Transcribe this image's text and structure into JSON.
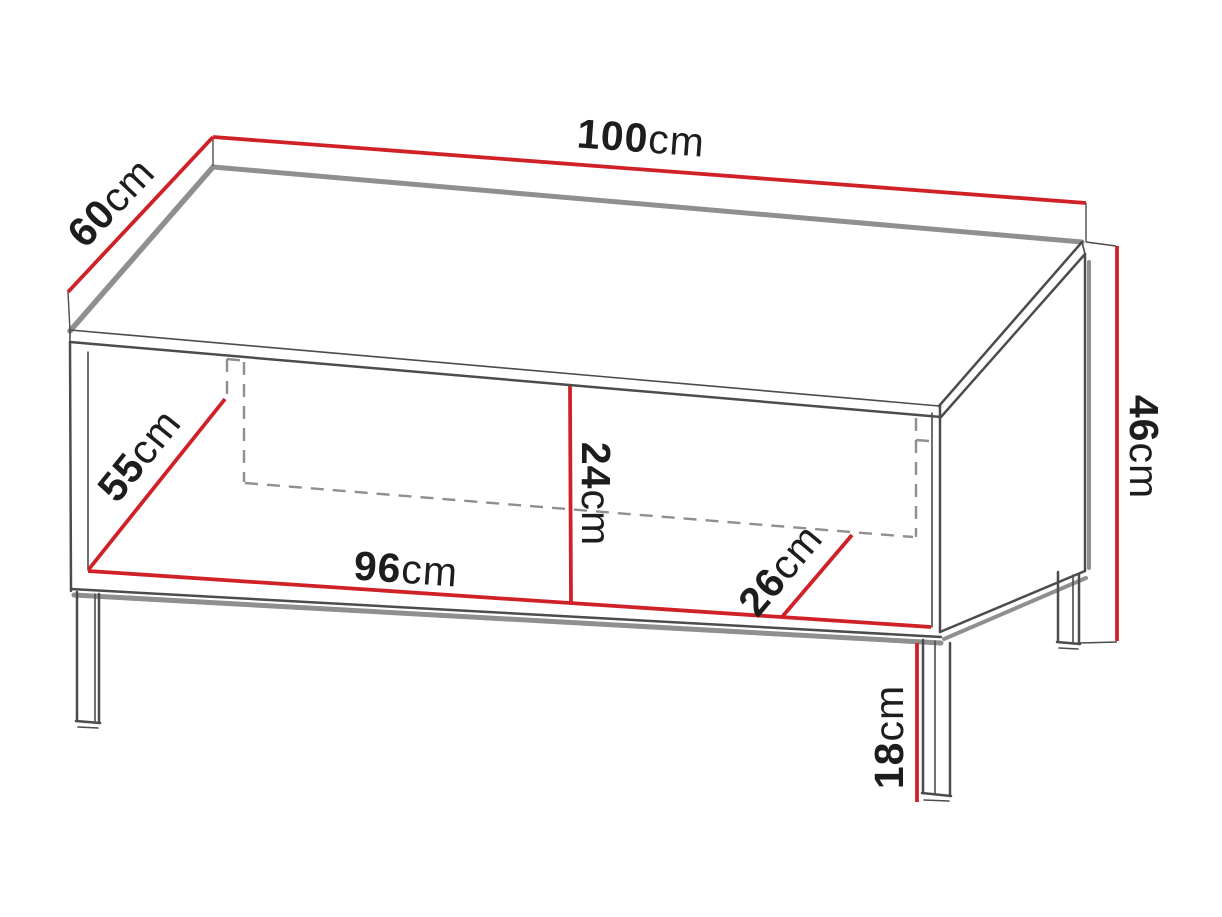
{
  "figure": {
    "title": "Coffee table dimension diagram",
    "background": "#ffffff",
    "colors": {
      "dimension_line": "#cf2127",
      "outline": "#4c4c4c",
      "shadow": "#8f8f8f",
      "hidden_edge": "#8f8f8f",
      "label_text": "#1d1d1b",
      "background": "#ffffff"
    },
    "dimensions": [
      {
        "id": "top-width",
        "value": "100",
        "unit": "cm"
      },
      {
        "id": "top-depth",
        "value": "60",
        "unit": "cm"
      },
      {
        "id": "body-height",
        "value": "46",
        "unit": "cm"
      },
      {
        "id": "inner-depth-diagonal",
        "value": "55",
        "unit": "cm"
      },
      {
        "id": "inner-height",
        "value": "24",
        "unit": "cm"
      },
      {
        "id": "inner-width",
        "value": "96",
        "unit": "cm"
      },
      {
        "id": "inner-shelf-depth",
        "value": "26",
        "unit": "cm"
      },
      {
        "id": "leg-height",
        "value": "18",
        "unit": "cm"
      }
    ]
  }
}
